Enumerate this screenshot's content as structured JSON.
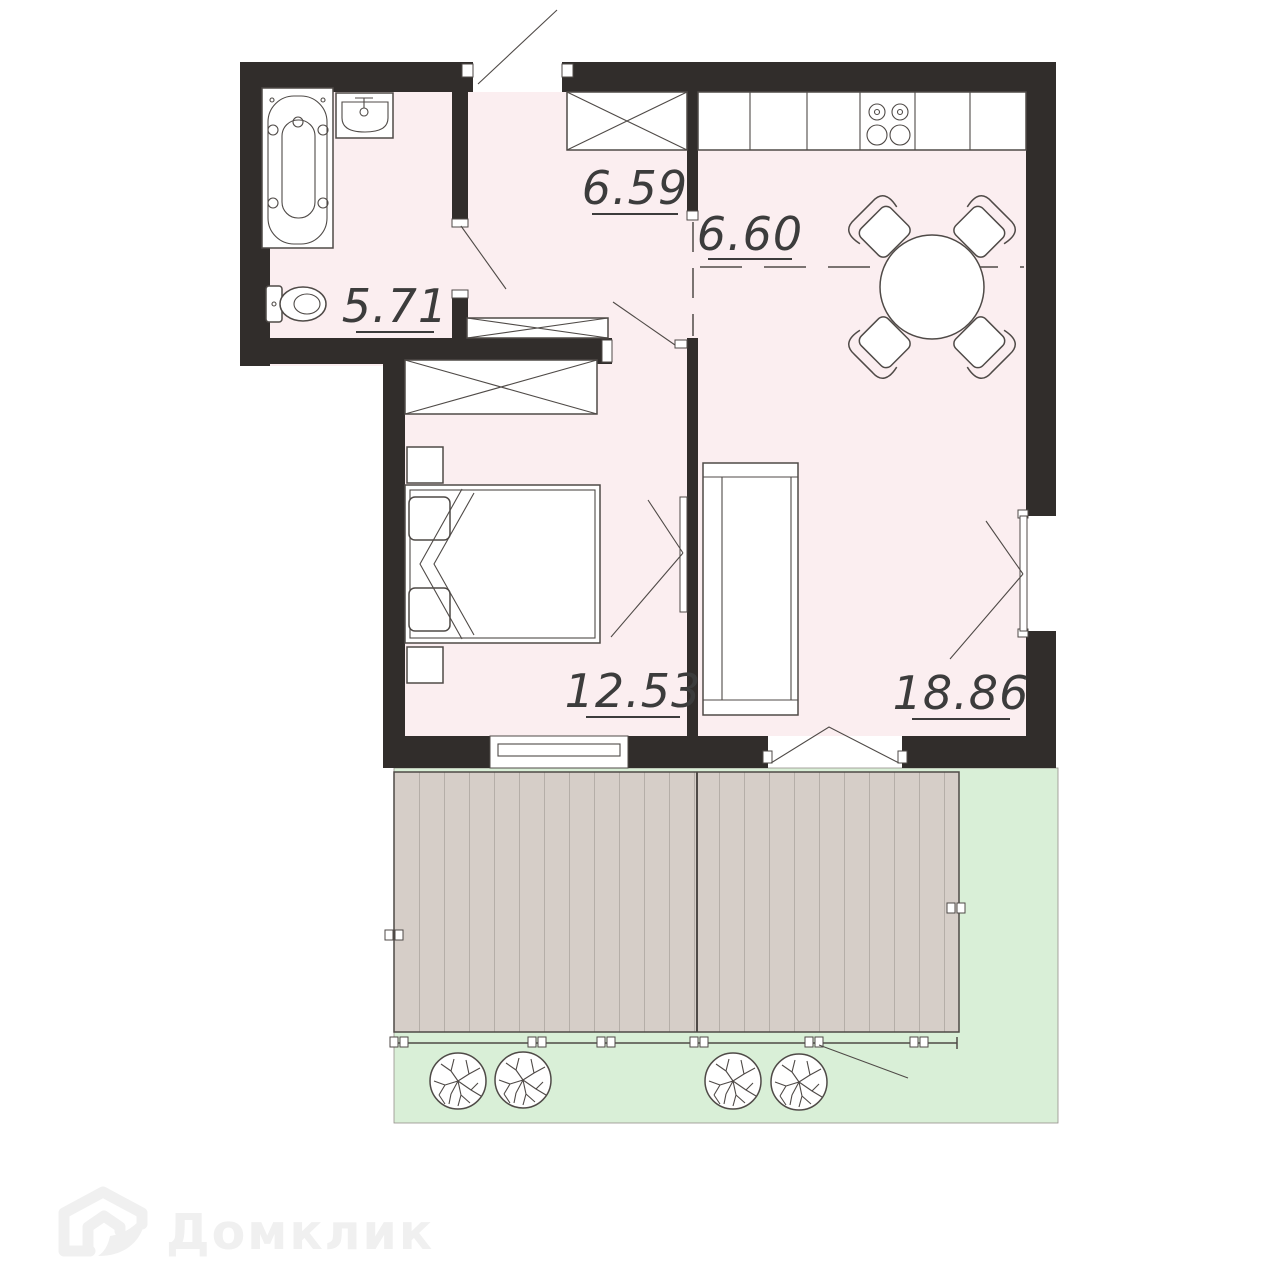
{
  "page": {
    "background": "#ffffff",
    "type": "apartment-floor-plan"
  },
  "colors": {
    "wall": "#312d2b",
    "floor": "#fbeef0",
    "line": "#4f4a47",
    "deck": "#d6cec8",
    "deck_line": "#948e89",
    "lawn": "#d9efd7",
    "label": "#3c3c3c",
    "watermark": "#f0f0f0"
  },
  "rooms": {
    "bathroom": {
      "name": "bathroom",
      "area_m2": "5.71"
    },
    "hallway": {
      "name": "hallway",
      "area_m2": "6.59"
    },
    "kitchen_dining": {
      "name": "kitchen-dining",
      "area_m2": "6.60"
    },
    "bedroom": {
      "name": "bedroom",
      "area_m2": "12.53"
    },
    "living_room": {
      "name": "living-room",
      "area_m2": "18.86"
    }
  },
  "fixtures": [
    "bathtub-icon",
    "sink-icon",
    "toilet-icon",
    "wardrobe-icon",
    "kitchen-counter-icon",
    "stove-icon",
    "dining-table-icon",
    "chair-icon",
    "bed-icon",
    "nightstand-icon",
    "sofa-icon",
    "window-icon",
    "door-swing-icon",
    "terrace-deck-icon",
    "tree-icon",
    "fence-icon"
  ],
  "watermark": {
    "brand": "Домклик",
    "icon": "domclick-house-icon"
  }
}
